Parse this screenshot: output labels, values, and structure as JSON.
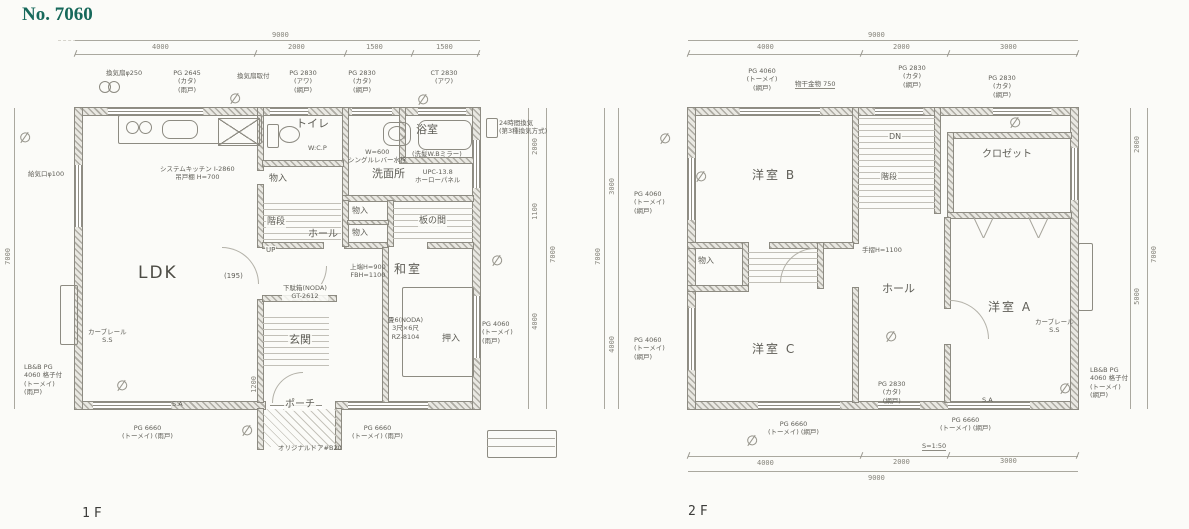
{
  "title": "No. 7060",
  "floor1": {
    "caption": "1F",
    "rooms": {
      "ldk": "LDK",
      "toilet": "トイレ",
      "washroom": "洗面所",
      "bath": "浴室",
      "closet_a": "物入",
      "closet_b": "物入",
      "closet_c": "物入",
      "stairs": "階段",
      "up": "UP",
      "hall": "ホール",
      "itanoma": "板の間",
      "washitsu": "和室",
      "oshiire": "押入",
      "genkan": "玄関",
      "porch": "ポーチ"
    },
    "dims": {
      "top_total": "9000",
      "top_segs": [
        "4000",
        "2000",
        "1500",
        "1500"
      ],
      "right_segs": [
        "2000",
        "1100",
        "4000"
      ],
      "right_total": "7000",
      "left_total": "7000",
      "porch_width": "1200"
    },
    "annotations": {
      "vent_fan": "換気扇φ250",
      "win_a": "PG 2645\n(カタ)\n(雨戸)",
      "mid_note": "換気扇取付",
      "win_b": "PG 2830\n(アワ)\n(網戸)",
      "win_c": "PG 2830\n(カタ)\n(網戸)",
      "win_d": "CT 2830\n(アワ)",
      "vent24": "24時間換気\n(第3種換気方式)",
      "kitchen": "システムキッチン I-2860\n吊戸棚 H=700",
      "toilet_note": "W:C.P",
      "wash_note": "W=600\nシングルレバー水栓",
      "mirror_note": "(洗髪W.Bミラー)",
      "bath_note": "UPC-13.8\nホーローパネル",
      "supply_air": "給気口φ100",
      "curtain": "カーブレール\nS.S",
      "win_left": "LB&B PG\n4060 格子付\n(トーメイ)\n(雨戸)",
      "win_right": "PG 4060\n(トーメイ)\n(雨戸)",
      "win_bottom_l": "PG 6660\n(トーメイ) (雨戸)",
      "win_bottom_r": "PG 6660\n(トーメイ) (雨戸)",
      "door": "オリジナルドア#B20",
      "shoe": "下駄箱(NODA)\nGT-2612",
      "stair_note": "上端H=900\nFBH=1100",
      "tatami": "畳6(NODA)\n3尺×6尺\nRZ-8104",
      "door_195": "(195)",
      "sa": "S.A"
    }
  },
  "floor2": {
    "caption": "2F",
    "rooms": {
      "room_b": "洋室 B",
      "room_c": "洋室 C",
      "room_a": "洋室 A",
      "closet": "クロゼット",
      "hall": "ホール",
      "stairs": "階段",
      "dn": "DN",
      "storage": "物入"
    },
    "dims": {
      "top_total": "9000",
      "top_segs": [
        "4000",
        "2000",
        "3000"
      ],
      "bottom_segs": [
        "4000",
        "2000",
        "3000"
      ],
      "bottom_total": "9000",
      "right_segs": [
        "2000",
        "5000"
      ],
      "right_total": "7000",
      "left_segs": [
        "3000",
        "4000"
      ],
      "left_total": "7000"
    },
    "annotations": {
      "win_a": "PG 4060\n(トーメイ)\n(網戸)",
      "laundry": "物干金物 750",
      "win_b": "PG 2830\n(カタ)\n(網戸)",
      "win_c": "PG 2830\n(カタ)\n(網戸)",
      "win_left1": "PG 4060\n(トーメイ)\n(網戸)",
      "win_left2": "PG 4060\n(トーメイ)\n(網戸)",
      "win_mid": "PG 2830\n(カタ)\n(網戸)",
      "handrail": "手摺H=1100",
      "curtain": "カーブレール\nS.S",
      "win_right": "LB&B PG\n4060 格子付\n(トーメイ)\n(網戸)",
      "win_bottom_l": "PG 6660\n(トーメイ) (網戸)",
      "win_bottom_r": "PG 6660\n(トーメイ) (網戸)",
      "scale_note": "S=1:50",
      "sa": "S.A"
    }
  }
}
